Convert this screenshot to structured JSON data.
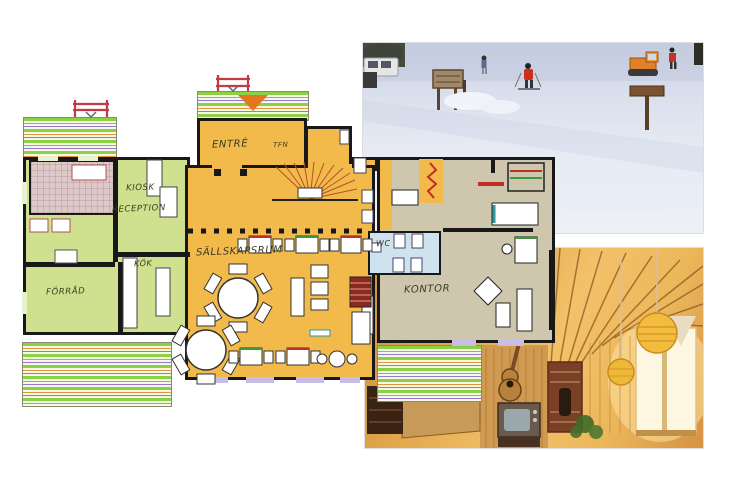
{
  "page": {
    "width": 740,
    "height": 477,
    "background": "#ffffff"
  },
  "floor_plan": {
    "labels": {
      "entre": "ENTRÉ",
      "tfn": "TFN",
      "kiosk": "KIOSK",
      "reception": "RECEPTION",
      "kok": "KÖK",
      "forrad": "FÖRRÅD",
      "sallskapsrum": "SÄLLSKAPSRUM",
      "wc": "WC",
      "kontor": "KONTOR"
    },
    "colors": {
      "wall": "#181818",
      "hall_orange": "#f2b94b",
      "wing_green": "#cfe08e",
      "office_beige": "#cfc6ae",
      "wc_blue": "#cfe3ee",
      "storage_pink": "#dcc9c9",
      "deck_stripe_green": "#8cd045",
      "deck_stripe_orange": "#e8943c",
      "deck_stripe_purple": "#9a78c8",
      "bench_red": "#c23a42",
      "entry_arrow_orange": "#e2771e",
      "window_lavender": "#c9bce6",
      "label_ink": "#3b3b24",
      "photo_snow_tint": "#dde3ee",
      "photo_wood_tint": "#e2a94f"
    }
  },
  "photos": {
    "top_right": "ski-slope-photo",
    "bottom_right": "wood-interior-photo"
  }
}
